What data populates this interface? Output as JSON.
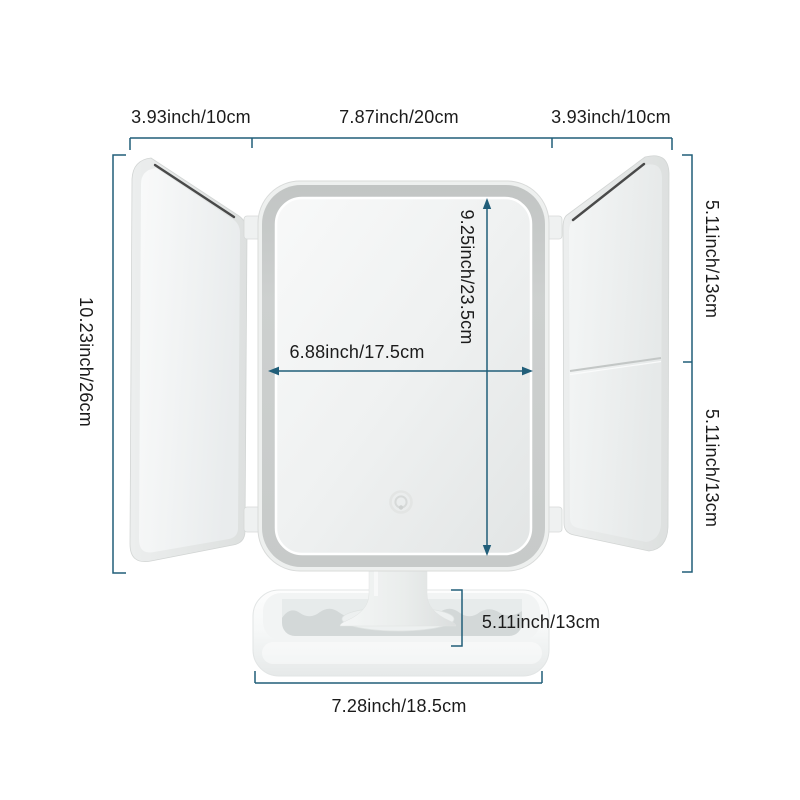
{
  "page": {
    "description": "Trifold LED vanity makeup mirror product dimension diagram",
    "background": "#ffffff"
  },
  "colors": {
    "dimension_line": "#215e79",
    "label_text": "#1b1b1b",
    "frame_gray": "#c9cccb",
    "product_white": "#f4f6f6",
    "mirror_edge_dark": "#222222"
  },
  "icons": {
    "touch_power_icon": "concentric-circles"
  },
  "dims": {
    "left_panel_width": "3.93inch/10cm",
    "center_panel_width": "7.87inch/20cm",
    "right_panel_width": "3.93inch/10cm",
    "total_height": "10.23inch/26cm",
    "right_upper_section_height": "5.11inch/13cm",
    "right_lower_section_height": "5.11inch/13cm",
    "mirror_height": "9.25inch/23.5cm",
    "mirror_width": "6.88inch/17.5cm",
    "base_height": "5.11inch/13cm",
    "base_width": "7.28inch/18.5cm"
  }
}
